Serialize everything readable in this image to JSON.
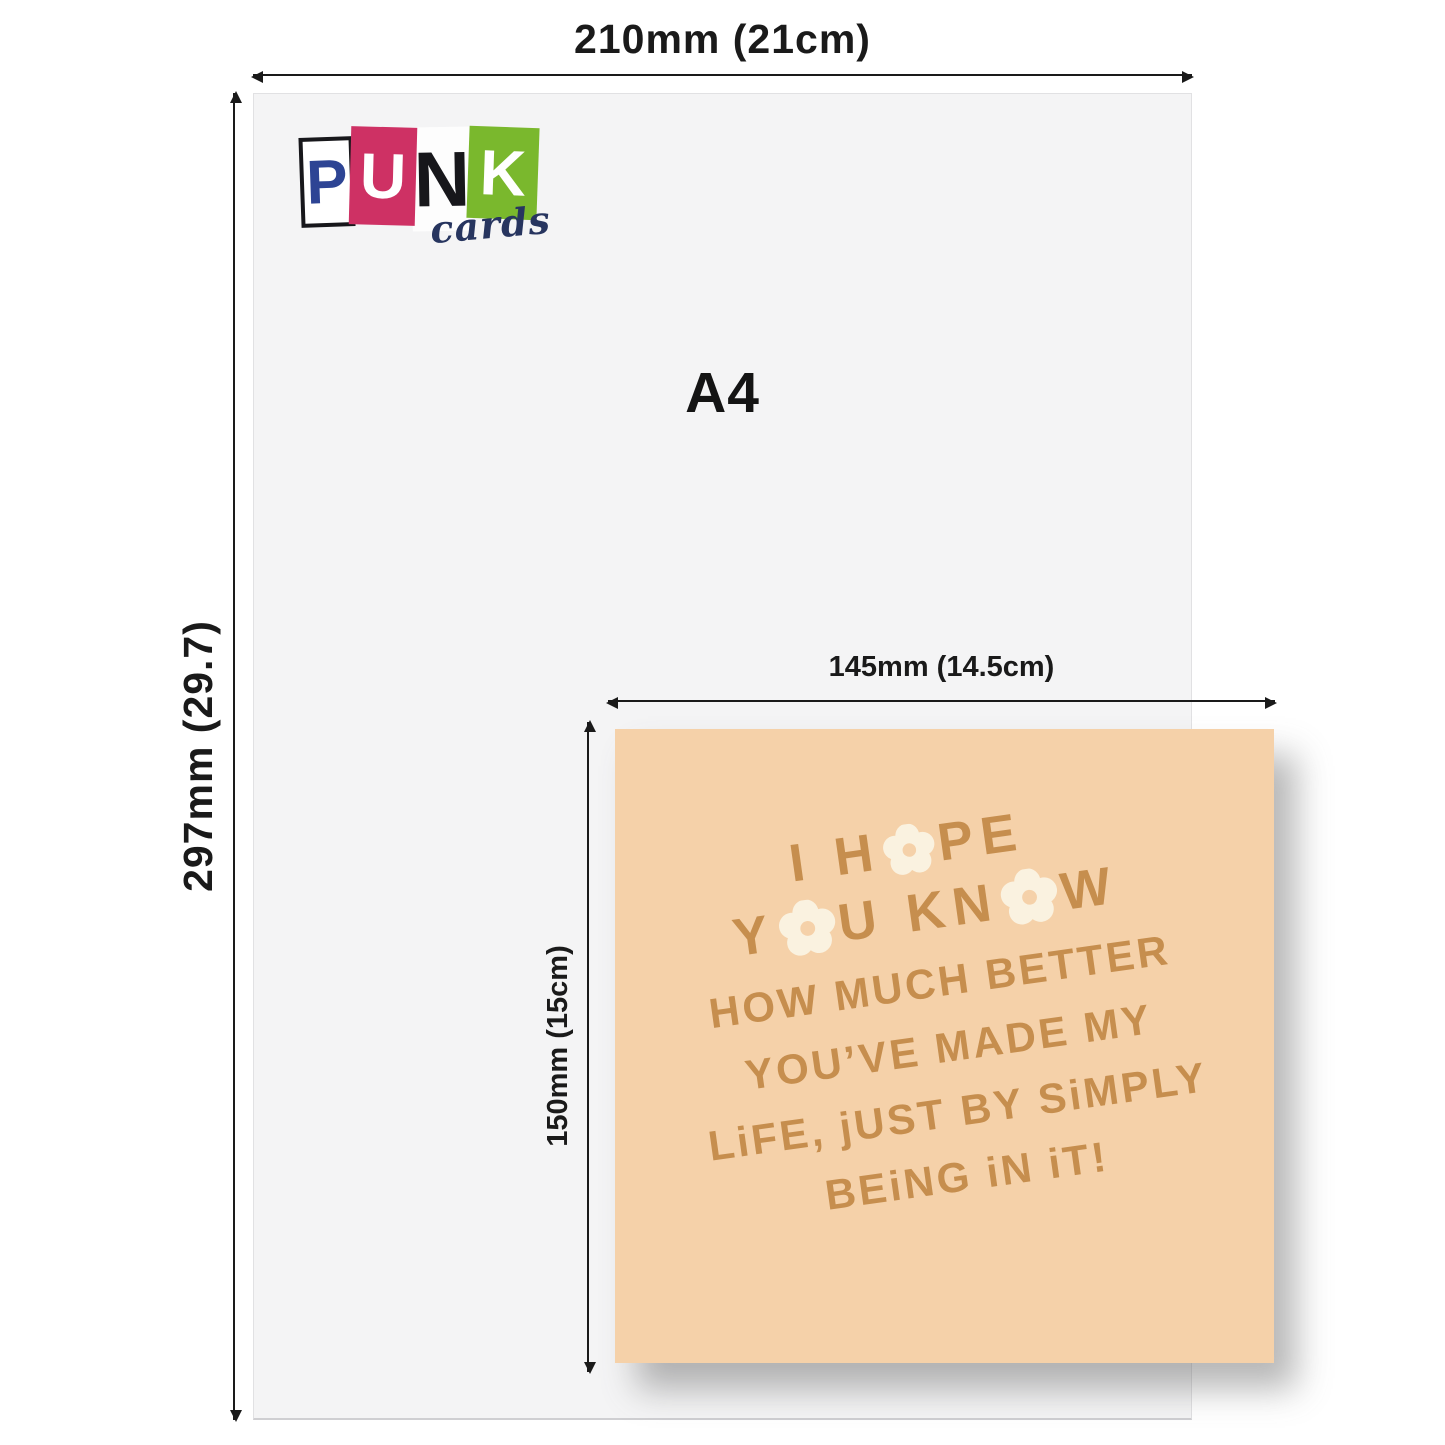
{
  "colors": {
    "dimension": "#1a1a1a",
    "sheet_bg": "#f4f4f5",
    "sheet_border": "#e1e1e3",
    "card_bg": "#f5d1a9",
    "card_text": "#c68e4e",
    "flower": "#faf2e0",
    "logo_blue": "#2d4494",
    "logo_pink": "#ce3164",
    "logo_green": "#7ab82d",
    "logo_navy": "#27355f",
    "logo_black": "#17171b"
  },
  "dimensions": {
    "a4_width": "210mm (21cm)",
    "a4_height": "297mm (29.7)",
    "card_width": "145mm (14.5cm)",
    "card_height": "150mm (15cm)"
  },
  "sheet": {
    "label": "A4"
  },
  "logo": {
    "letters": [
      "P",
      "U",
      "N",
      "K"
    ],
    "word": "cards"
  },
  "card": {
    "line1_pre": "I H",
    "line1_post": "PE",
    "line2_pre": "Y",
    "line2_mid": "U KN",
    "line2_post": "W",
    "line3": "HOW MUCH BETTER",
    "line4": "YOU’VE MADE MY",
    "line5": "LiFE, jUST BY SiMPLY",
    "line6": "BEiNG iN iT!"
  }
}
